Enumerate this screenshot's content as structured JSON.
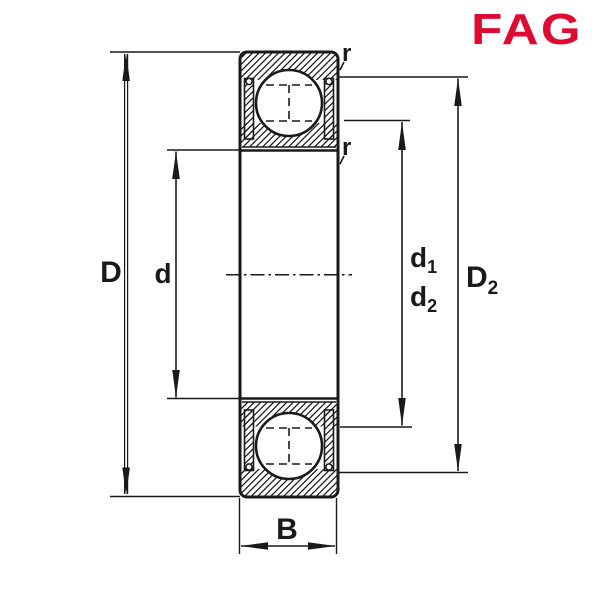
{
  "brand": {
    "text": "FAG",
    "color": "#df0a30"
  },
  "drawing": {
    "ink": "#1a1a1a",
    "labels": {
      "D": {
        "main": "D",
        "sub": ""
      },
      "d": {
        "main": "d",
        "sub": ""
      },
      "d1": {
        "main": "d",
        "sub": "1"
      },
      "d2": {
        "main": "d",
        "sub": "2"
      },
      "D2": {
        "main": "D",
        "sub": "2"
      },
      "B": {
        "main": "B",
        "sub": ""
      },
      "r_outer": {
        "text": "r"
      },
      "r_inner": {
        "text": "r"
      }
    }
  }
}
